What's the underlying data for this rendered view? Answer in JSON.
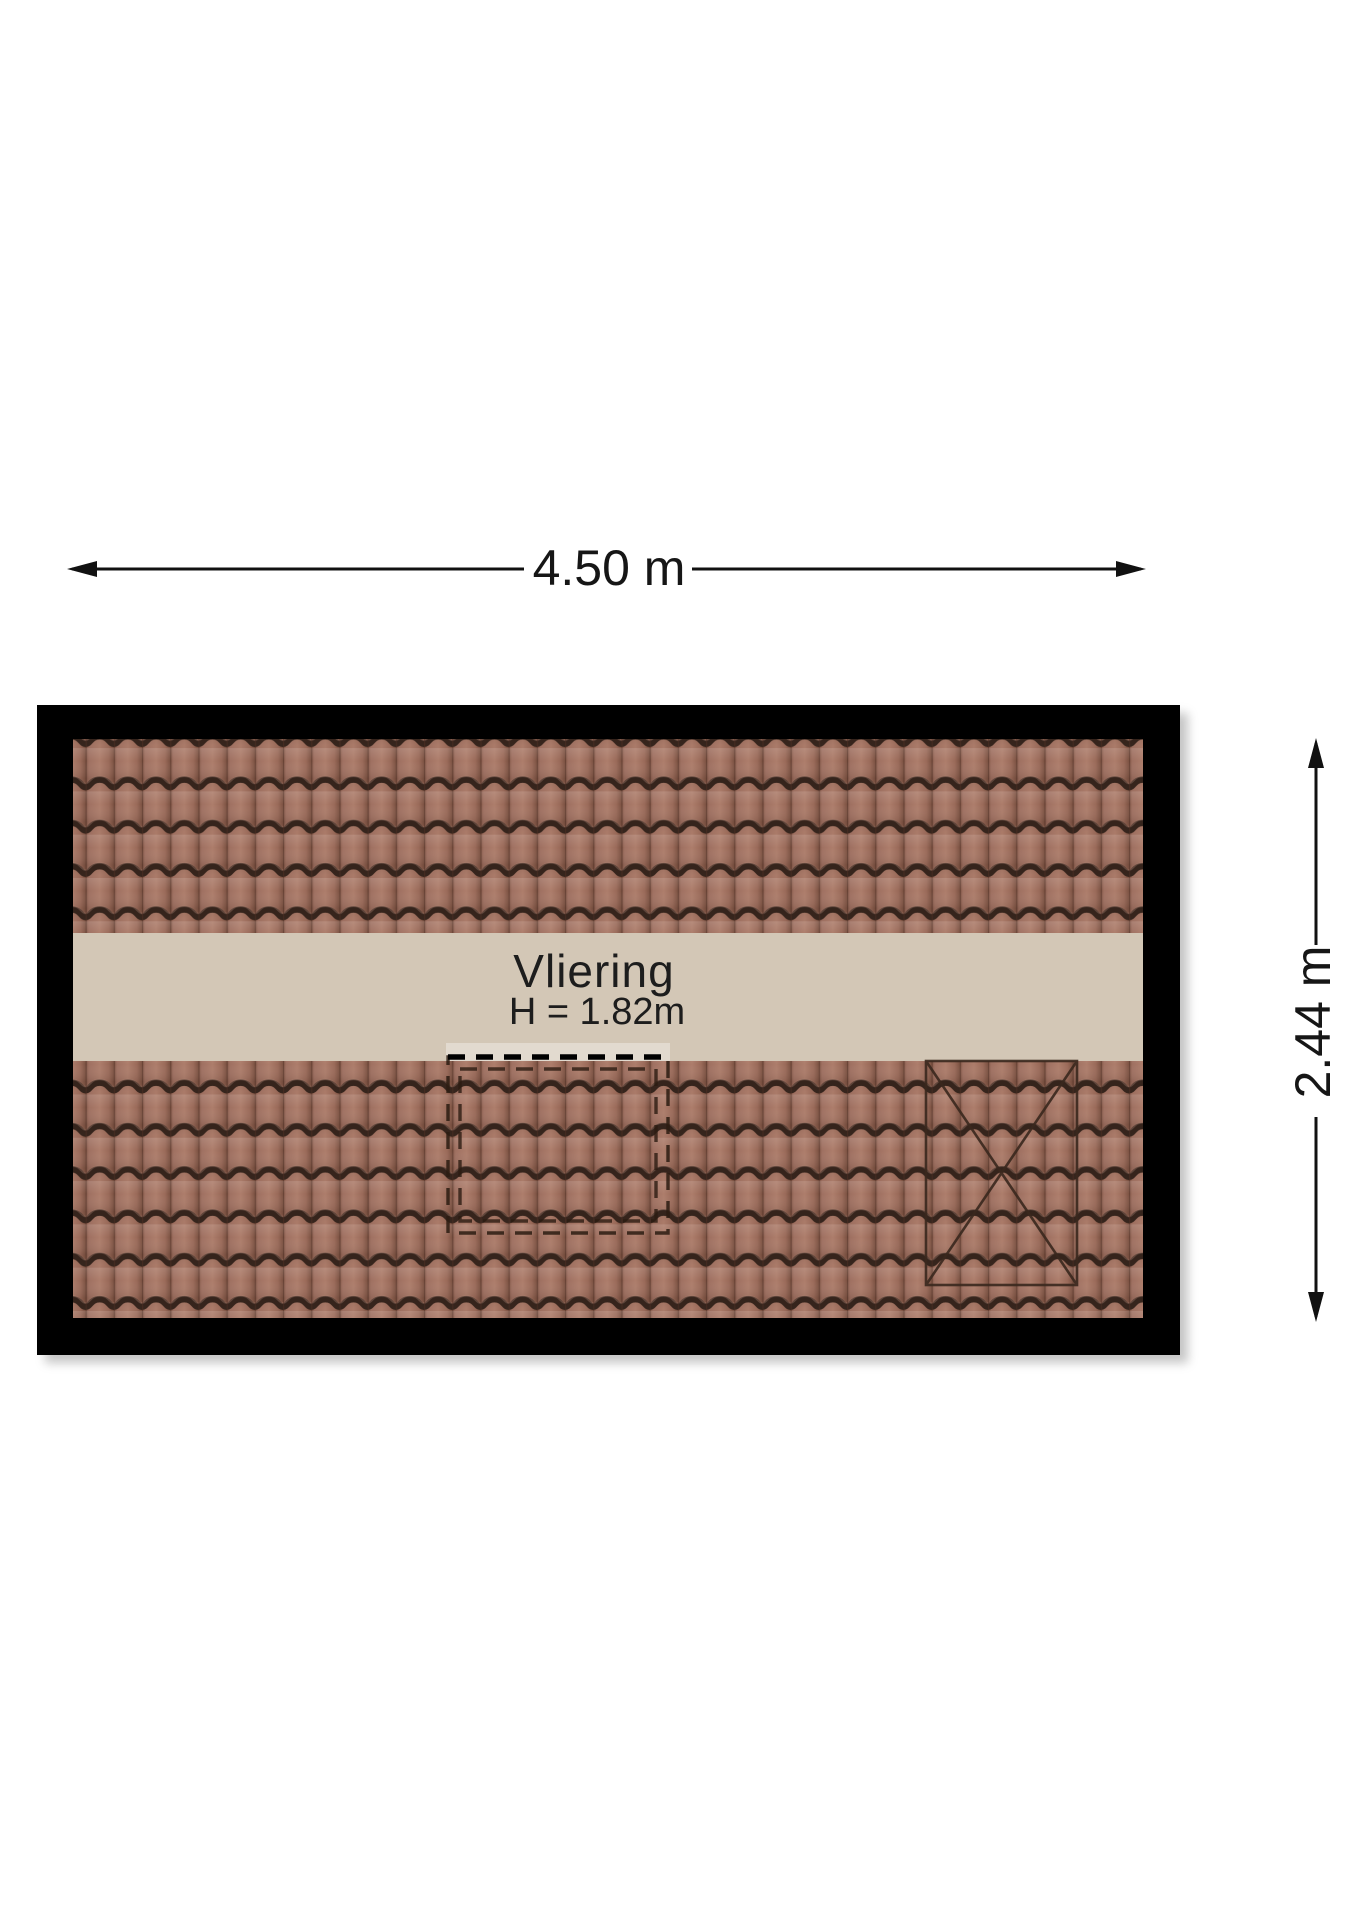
{
  "floorplan": {
    "room": {
      "name": "Vliering",
      "height_label": "H = 1.82m"
    },
    "dimensions": {
      "width": "4.50 m",
      "height": "2.44 m"
    },
    "colors": {
      "frame": "#000000",
      "attic_floor": "#d3c7b6",
      "roof_tile": "#a4715f",
      "tile_groove": "#36251d",
      "dimension_lines": "#111111",
      "background": "#ffffff"
    }
  }
}
